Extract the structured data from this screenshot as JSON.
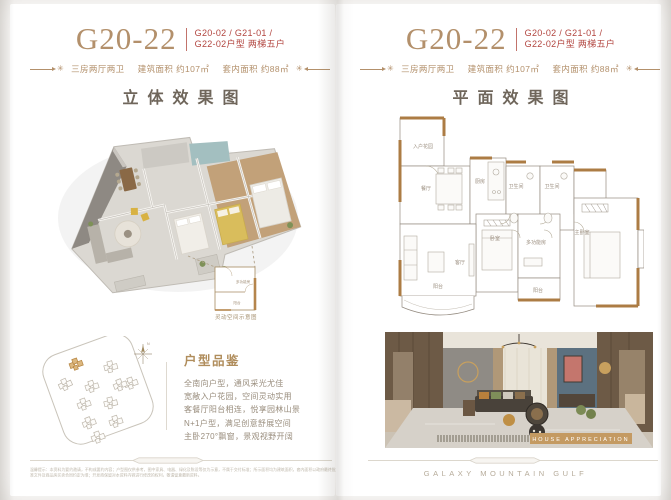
{
  "colors": {
    "accent_gold": "#b3906b",
    "red": "#b2453f",
    "title_dark": "#6f665b",
    "wall_gold": "#ac7c44",
    "banner_gold": "#c49a62"
  },
  "left_page": {
    "header": {
      "model": "G20-22",
      "codes_line1": "G20-02 / G21-01 /",
      "codes_line2": "G22-02户型 两梯五户",
      "star": "✳",
      "spec_rooms": "三房两厅两卫",
      "spec_area": "建筑面积 约107㎡",
      "spec_inner": "套内面积 约88㎡"
    },
    "section_title": "立体效果图",
    "inset": {
      "room_top": "多功能房",
      "room_bottom": "阳台",
      "caption": "灵动空间示意图"
    },
    "siteplan": {
      "compass": "N"
    },
    "review": {
      "title": "户型品鉴",
      "lines": [
        "全南向户型，通风采光尤佳",
        "宽敞入户花园，空间灵动实用",
        "客餐厅阳台相连，悦享园林山景",
        "N+1户型，满足创意舒展空间",
        "主卧270°飘窗，景观视野开阔"
      ]
    },
    "disclaimer": "温馨提示：本资料为要约邀请，不构成要约内容；户型图仅供参考，图中家具、电器、绿化及陈设等仅为示意，不属于交付标准；所示面积均为建筑面积，套内面积以政府最终批准文件及商品房买卖合同约定为准；开发商保留对本资料内容进行修改的权利，敬请留意最新资料。"
  },
  "right_page": {
    "header": {
      "model": "G20-22",
      "codes_line1": "G20-02 / G21-01 /",
      "codes_line2": "G22-02户型 两梯五户",
      "star": "✳",
      "spec_rooms": "三房两厅两卫",
      "spec_area": "建筑面积 约107㎡",
      "spec_inner": "套内面积 约88㎡"
    },
    "section_title": "平面效果图",
    "plan": {
      "rooms": {
        "entry": "入户花园",
        "dining": "餐厅",
        "kitchen": "厨房",
        "bath1": "卫生间",
        "bath2": "卫生间",
        "living": "客厅",
        "bedroom": "卧室",
        "multi": "多功能房",
        "master": "主卧室",
        "balcony_side": "阳台",
        "balcony_main": "阳台"
      }
    },
    "photo": {
      "banner": "HOUSE APPRECIATION"
    },
    "footer_brand": "GALAXY MOUNTAIN GULF"
  }
}
